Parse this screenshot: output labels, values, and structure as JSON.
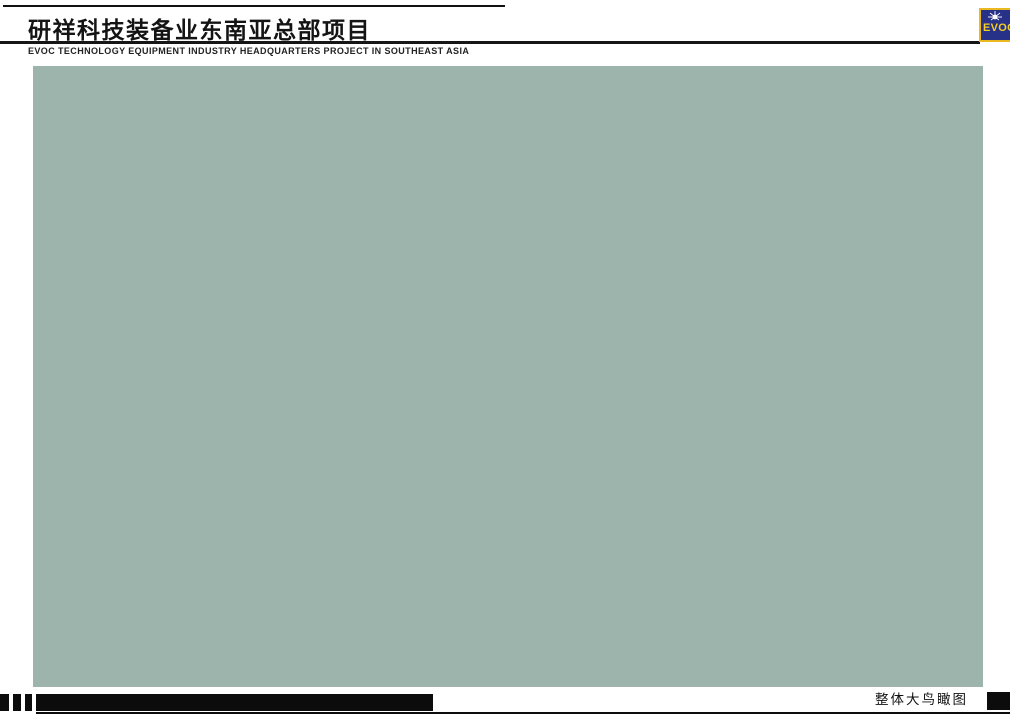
{
  "header": {
    "title_cn": "研祥科技装备业东南亚总部项目",
    "subtitle_en": "EVOC TECHNOLOGY EQUIPMENT INDUSTRY HEADQUARTERS PROJECT IN SOUTHEAST ASIA",
    "logo": {
      "text": "EVOC",
      "bg_color": "#263187",
      "accent_color": "#f5d020"
    }
  },
  "footer": {
    "caption_cn": "整体大鸟瞰图"
  },
  "scene": {
    "palette": {
      "haze_top": "#b6cad1",
      "field": "#93ae75",
      "road": "#939ea6",
      "road_light": "#a6b1b8",
      "lane": "#eef2f4",
      "median": "#46633c",
      "sidewalk_brown": "#6f5040",
      "campus_base": "#859c62",
      "facade": "#e7d9a6",
      "plaza": "#ddc79b",
      "hall_roof": "#7fa357",
      "tower_dark": "#46555f",
      "tower_cap": "#e2e8ea",
      "white_bldg": "#e9eef0",
      "resi_dark": "#3f4b55",
      "resi_stripe": "#e6ebee",
      "yellow_tree": "#c4ae4e",
      "red_plaza": "#b06848",
      "shadow": "rgba(25,40,28,0.38)"
    },
    "roof_colors": [
      "#9fb27c",
      "#a9ba86",
      "#b2c08e",
      "#93a873",
      "#8fa3a8"
    ],
    "car_colors": [
      "#f2f4f5",
      "#23292e",
      "#c23528",
      "#2a4fa0",
      "#d9dcdd",
      "#e0a020"
    ]
  }
}
